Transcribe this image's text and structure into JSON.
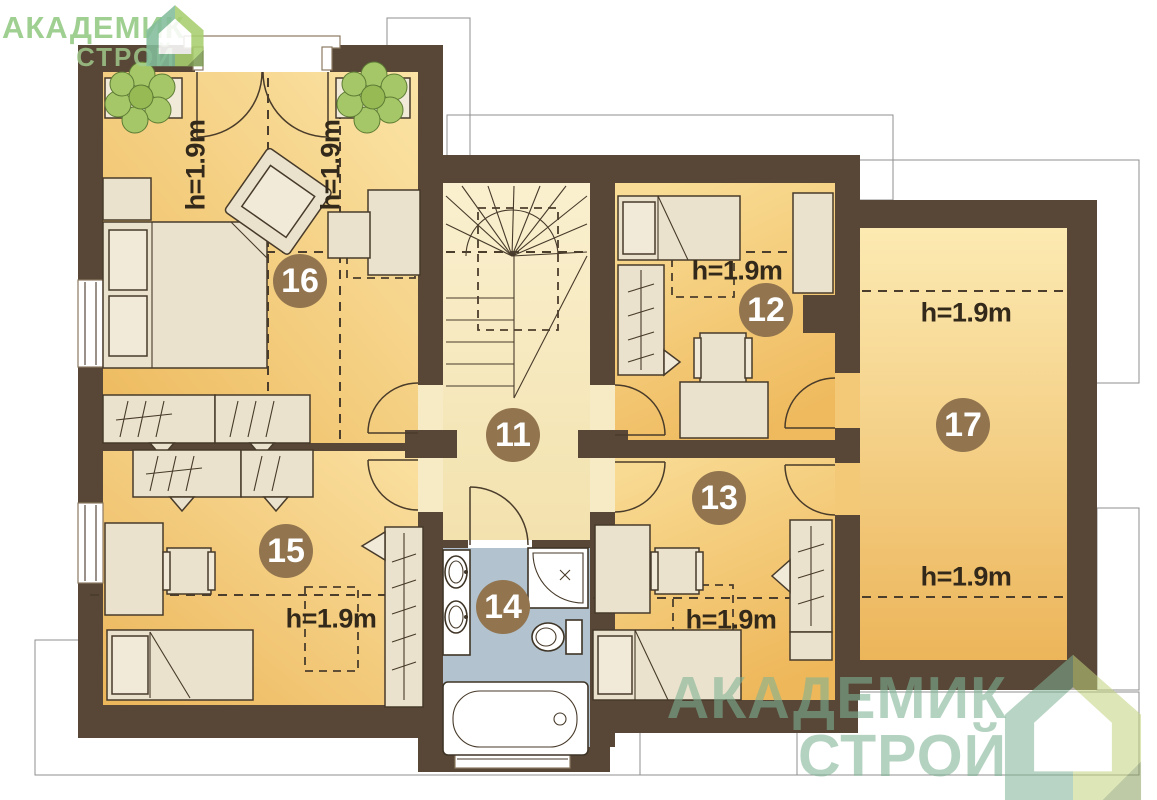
{
  "watermark": {
    "line1": "АКАДЕМИК",
    "line2": "СТРОЙ"
  },
  "plan": {
    "rooms": [
      {
        "number": "11",
        "height_labels": []
      },
      {
        "number": "12",
        "height_labels": [
          "h=1.9m"
        ]
      },
      {
        "number": "13",
        "height_labels": [
          "h=1.9m"
        ]
      },
      {
        "number": "14",
        "height_labels": []
      },
      {
        "number": "15",
        "height_labels": [
          "h=1.9m"
        ]
      },
      {
        "number": "16",
        "height_labels": [
          "h=1.9m",
          "h=1.9m"
        ]
      },
      {
        "number": "17",
        "height_labels": [
          "h=1.9m",
          "h=1.9m"
        ]
      }
    ]
  },
  "colors": {
    "wall": "#584737",
    "floor_room": "#edb95c",
    "floor_room_light": "#fbe4a6",
    "floor_hall": "#f7ecc6",
    "floor_bath": "#b2c2cf",
    "furniture": "#eae2cc",
    "badge_bg": "#92754f",
    "badge_text": "#ffffff",
    "dash_line": "#4c3e2c",
    "logo_green_text": "#8fc77e",
    "logo_teal": "#7fb294",
    "logo_lime": "#c3d37e",
    "plant_leaf": "#a6c768"
  }
}
